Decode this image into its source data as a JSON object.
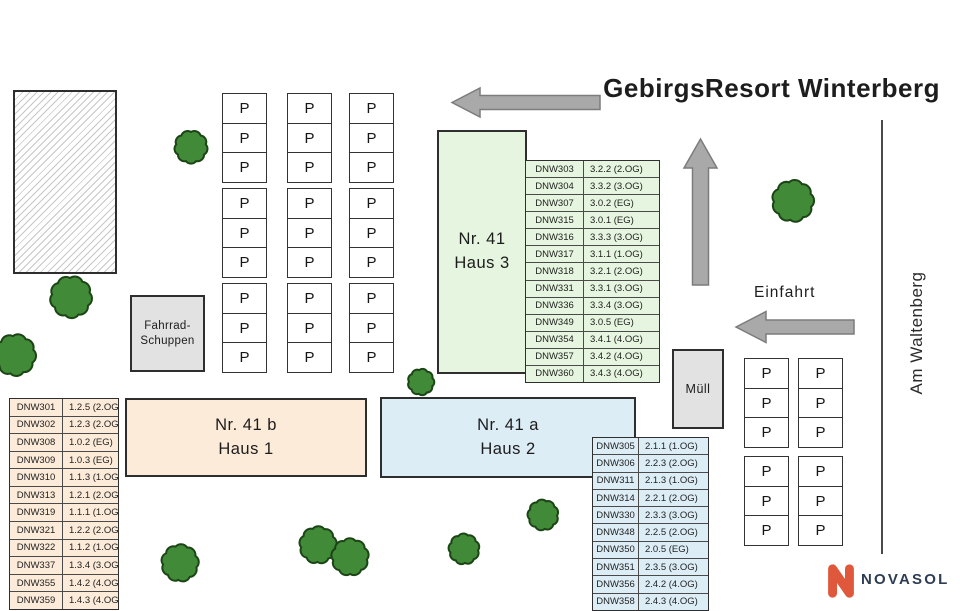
{
  "site": {
    "title": "GebirgsResort Winterberg"
  },
  "street": {
    "name": "Am Waltenberg"
  },
  "entrance": {
    "label": "Einfahrt"
  },
  "buildings": {
    "haus3": {
      "label": "Nr. 41\nHaus 3"
    },
    "haus1": {
      "label": "Nr. 41 b\nHaus 1"
    },
    "haus2": {
      "label": "Nr. 41 a\nHaus 2"
    },
    "muell": {
      "label": "Müll"
    },
    "fahrrad_schuppen": {
      "label": "Fahrrad-\nSchuppen"
    }
  },
  "parking": {
    "space_label": "P"
  },
  "tables": {
    "haus3": {
      "rows": [
        [
          "DNW303",
          "3.2.2 (2.OG)"
        ],
        [
          "DNW304",
          "3.3.2 (3.OG)"
        ],
        [
          "DNW307",
          "3.0.2 (EG)"
        ],
        [
          "DNW315",
          "3.0.1 (EG)"
        ],
        [
          "DNW316",
          "3.3.3 (3.OG)"
        ],
        [
          "DNW317",
          "3.1.1 (1.OG)"
        ],
        [
          "DNW318",
          "3.2.1 (2.OG)"
        ],
        [
          "DNW331",
          "3.3.1 (3.OG)"
        ],
        [
          "DNW336",
          "3.3.4 (3.OG)"
        ],
        [
          "DNW349",
          "3.0.5 (EG)"
        ],
        [
          "DNW354",
          "3.4.1 (4.OG)"
        ],
        [
          "DNW357",
          "3.4.2 (4.OG)"
        ],
        [
          "DNW360",
          "3.4.3 (4.OG)"
        ]
      ]
    },
    "haus1": {
      "rows": [
        [
          "DNW301",
          "1.2.5 (2.OG)"
        ],
        [
          "DNW302",
          "1.2.3 (2.OG)"
        ],
        [
          "DNW308",
          "1.0.2 (EG)"
        ],
        [
          "DNW309",
          "1.0.3 (EG)"
        ],
        [
          "DNW310",
          "1.1.3 (1.OG)"
        ],
        [
          "DNW313",
          "1.2.1 (2.OG)"
        ],
        [
          "DNW319",
          "1.1.1 (1.OG)"
        ],
        [
          "DNW321",
          "1.2.2 (2.OG)"
        ],
        [
          "DNW322",
          "1.1.2 (1.OG)"
        ],
        [
          "DNW337",
          "1.3.4 (3.OG)"
        ],
        [
          "DNW355",
          "1.4.2 (4.OG)"
        ],
        [
          "DNW359",
          "1.4.3 (4.OG)"
        ]
      ]
    },
    "haus2": {
      "rows": [
        [
          "DNW305",
          "2.1.1 (1.OG)"
        ],
        [
          "DNW306",
          "2.2.3 (2.OG)"
        ],
        [
          "DNW311",
          "2.1.3 (1.OG)"
        ],
        [
          "DNW314",
          "2.2.1 (2.OG)"
        ],
        [
          "DNW330",
          "2.3.3 (3.OG)"
        ],
        [
          "DNW348",
          "2.2.5 (2.OG)"
        ],
        [
          "DNW350",
          "2.0.5 (EG)"
        ],
        [
          "DNW351",
          "2.3.5 (3.OG)"
        ],
        [
          "DNW356",
          "2.4.2 (4.OG)"
        ],
        [
          "DNW358",
          "2.4.3 (4.OG)"
        ]
      ]
    }
  },
  "logo": {
    "brand": "NOVASOL"
  },
  "colors": {
    "haus1_fill": "#fcebd9",
    "haus1_tbl": "#fcebd9",
    "haus2_fill": "#dcedf6",
    "haus2_tbl": "#dcedf6",
    "haus3_fill": "#e6f5df",
    "haus3_tbl": "#e6f5df",
    "shed_fill": "#e2e2e2",
    "arrow_gray": "#a9a9a9",
    "arrow_border": "#7c7c7c",
    "tree_green": "#418a38",
    "tree_outline": "#1c4516",
    "brand_orange": "#e0583c",
    "brand_navy": "#2e3d52"
  }
}
